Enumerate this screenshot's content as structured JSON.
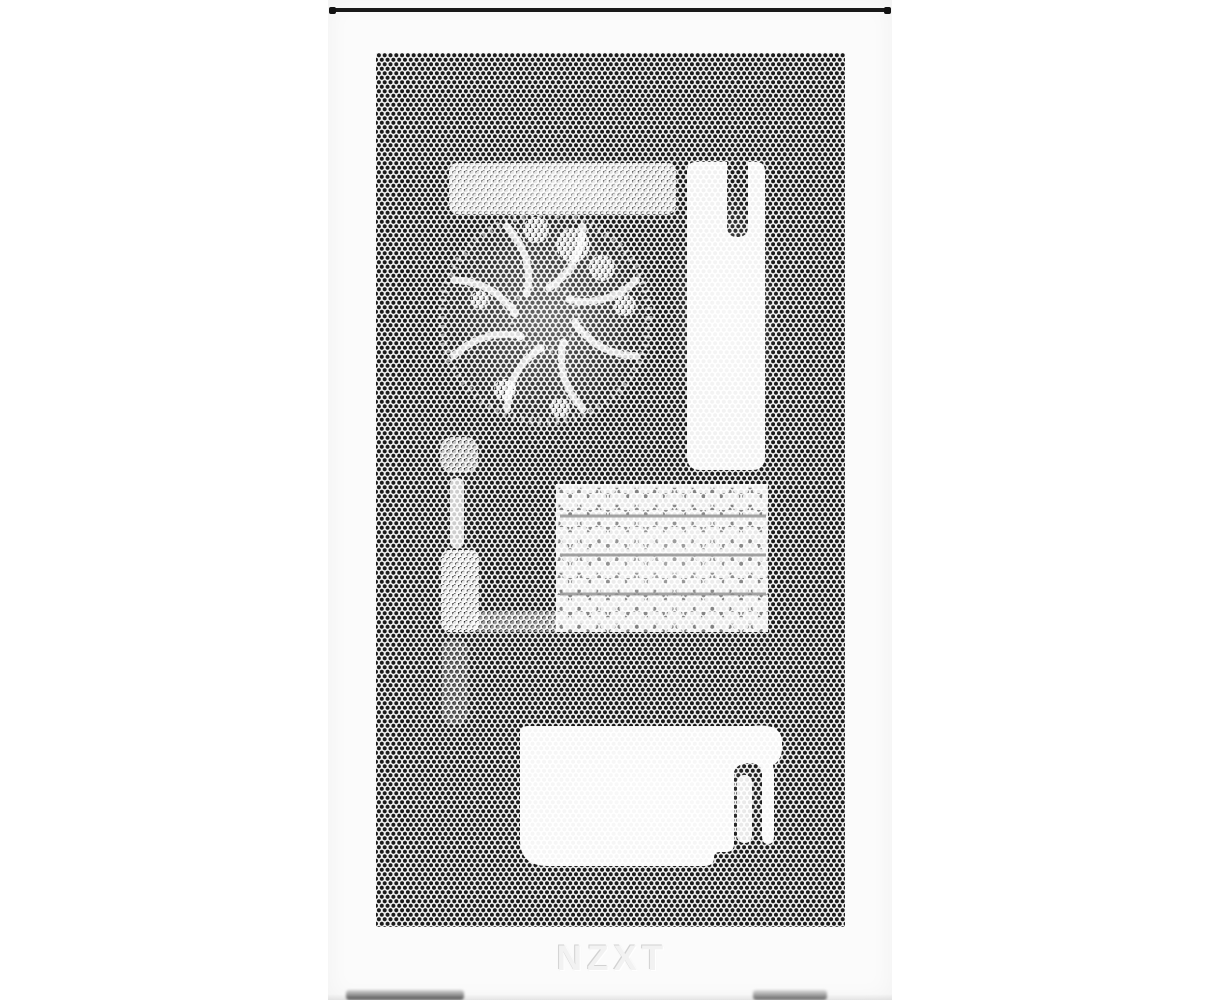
{
  "photo": {
    "brand": "NZXT",
    "colors": {
      "background": "#ffffff",
      "panel": "#fbfbfb",
      "mesh_dots": "#1b1b1b",
      "top_edge_line": "#191919",
      "logo": "#f2f2f2",
      "foot_shadow": "#565656"
    },
    "silhouette_shapes": [
      "cooling-fan",
      "radiator-top-band",
      "rear-bracket",
      "gpu-heatsink-fins",
      "psu-shroud",
      "cable-slots",
      "side-reflection-strips"
    ]
  },
  "panel": {
    "logo_text": "NZXT"
  }
}
